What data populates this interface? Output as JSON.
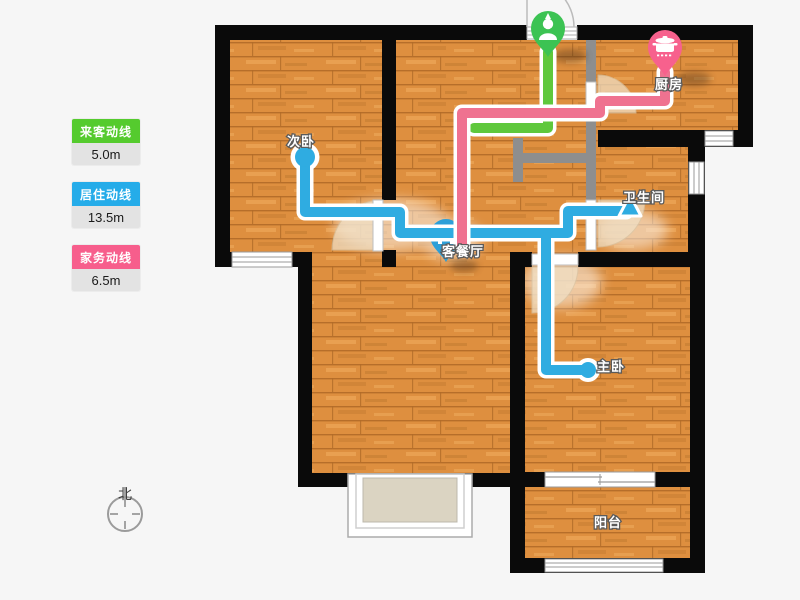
{
  "legend": {
    "items": [
      {
        "label": "来客动线",
        "value": "5.0m",
        "color": "#55CB2E"
      },
      {
        "label": "居住动线",
        "value": "13.5m",
        "color": "#25ACE9"
      },
      {
        "label": "家务动线",
        "value": "6.5m",
        "color": "#F75E8C"
      }
    ]
  },
  "compass": {
    "north": "北"
  },
  "floorplan": {
    "rooms": [
      {
        "name": "次卧"
      },
      {
        "name": "厨房"
      },
      {
        "name": "卫生间"
      },
      {
        "name": "客餐厅"
      },
      {
        "name": "主卧"
      },
      {
        "name": "阳台"
      }
    ]
  },
  "colors": {
    "line_guest": "#5FC83C",
    "line_living": "#2FACE1",
    "line_house": "#EF7290",
    "pin_guest": "#3CC353",
    "pin_living": "#2D9FD8",
    "pin_house": "#F7618D",
    "wall": "#0A0A0A"
  }
}
